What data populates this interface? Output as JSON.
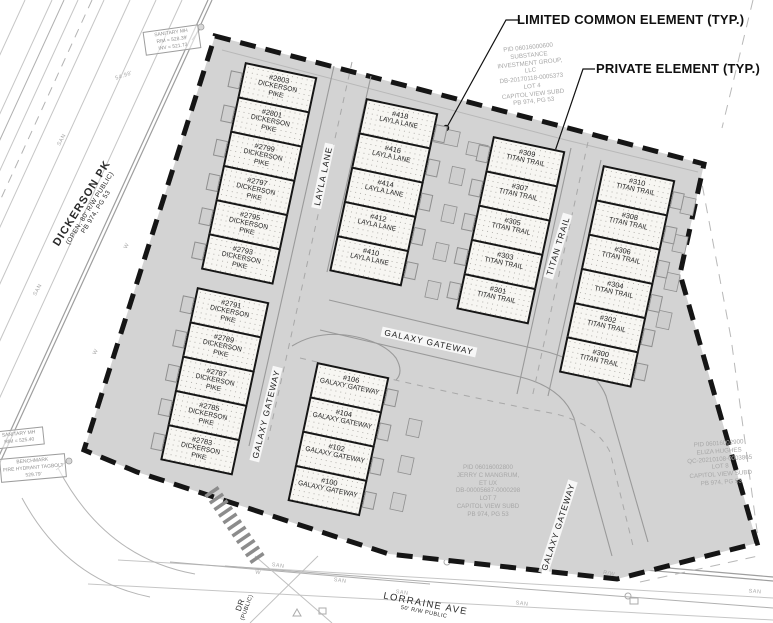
{
  "annotations": {
    "limited_common": "LIMITED COMMON ELEMENT (TYP.)",
    "private": "PRIVATE ELEMENT (TYP.)"
  },
  "streets": {
    "dickerson": {
      "name": "DICKERSON PK",
      "line2": "(OPEN, 80' R/W PUBLIC)",
      "line3": "PB 974, PG 53"
    },
    "layla_label": "LAYLA LANE",
    "titan_label": "TITAN TRAIL",
    "galaxy_label": "GALAXY GATEWAY",
    "lorraine": {
      "name": "LORRAINE AVE",
      "line2": "50' R/W PUBLIC"
    },
    "dr": {
      "name": "DR",
      "line2": "(PUBLIC)"
    }
  },
  "unit_columns": [
    {
      "name": "dickerson-pike-upper",
      "units": [
        {
          "number": "#2803",
          "street": "DICKERSON PIKE"
        },
        {
          "number": "#2801",
          "street": "DICKERSON PIKE"
        },
        {
          "number": "#2799",
          "street": "DICKERSON PIKE"
        },
        {
          "number": "#2797",
          "street": "DICKERSON PIKE"
        },
        {
          "number": "#2795",
          "street": "DICKERSON PIKE"
        },
        {
          "number": "#2793",
          "street": "DICKERSON PIKE"
        }
      ]
    },
    {
      "name": "dickerson-pike-lower",
      "units": [
        {
          "number": "#2791",
          "street": "DICKERSON PIKE"
        },
        {
          "number": "#2789",
          "street": "DICKERSON PIKE"
        },
        {
          "number": "#2787",
          "street": "DICKERSON PIKE"
        },
        {
          "number": "#2785",
          "street": "DICKERSON PIKE"
        },
        {
          "number": "#2783",
          "street": "DICKERSON PIKE"
        }
      ]
    },
    {
      "name": "layla-lane",
      "units": [
        {
          "number": "#418",
          "street": "LAYLA LANE"
        },
        {
          "number": "#416",
          "street": "LAYLA LANE"
        },
        {
          "number": "#414",
          "street": "LAYLA LANE"
        },
        {
          "number": "#412",
          "street": "LAYLA LANE"
        },
        {
          "number": "#410",
          "street": "LAYLA LANE"
        }
      ]
    },
    {
      "name": "titan-trail-west",
      "units": [
        {
          "number": "#309",
          "street": "TITAN TRAIL"
        },
        {
          "number": "#307",
          "street": "TITAN TRAIL"
        },
        {
          "number": "#305",
          "street": "TITAN TRAIL"
        },
        {
          "number": "#303",
          "street": "TITAN TRAIL"
        },
        {
          "number": "#301",
          "street": "TITAN TRAIL"
        }
      ]
    },
    {
      "name": "titan-trail-east",
      "units": [
        {
          "number": "#310",
          "street": "TITAN TRAIL"
        },
        {
          "number": "#308",
          "street": "TITAN TRAIL"
        },
        {
          "number": "#306",
          "street": "TITAN TRAIL"
        },
        {
          "number": "#304",
          "street": "TITAN TRAIL"
        },
        {
          "number": "#302",
          "street": "TITAN TRAIL"
        },
        {
          "number": "#300",
          "street": "TITAN TRAIL"
        }
      ]
    },
    {
      "name": "galaxy-gateway",
      "units": [
        {
          "number": "#106",
          "street": "GALAXY GATEWAY"
        },
        {
          "number": "#104",
          "street": "GALAXY GATEWAY"
        },
        {
          "number": "#102",
          "street": "GALAXY GATEWAY"
        },
        {
          "number": "#100",
          "street": "GALAXY GATEWAY"
        }
      ]
    }
  ],
  "parcels": [
    {
      "name": "lot-4",
      "lines": [
        "PID 06016000600",
        "SUBSTANCE",
        "INVESTMENT GROUP,",
        "LLC",
        "DB-20170118-0005373",
        "LOT 4",
        "CAPITOL VIEW SUBD",
        "PB 974, PG 53"
      ]
    },
    {
      "name": "lot-7",
      "lines": [
        "PID 06016002800",
        "JERRY C MANGRUM,",
        "ET UX",
        "DB-00005687-0000298",
        "LOT 7",
        "CAPITOL VIEW SUBD",
        "PB 974, PG 53"
      ]
    },
    {
      "name": "lot-8",
      "lines": [
        "PID 06016002900",
        "ELIZA HUGHES",
        "QC-20210108-0003865",
        "LOT 8",
        "CAPITOL VIEW SUBD",
        "PB 974, PG 53"
      ]
    }
  ],
  "survey_notes": [
    {
      "name": "sanitary-mh-north",
      "lines": [
        "SANITARY MH",
        "RIM = 528.39'",
        "INV = 521.73"
      ]
    },
    {
      "name": "sanitary-mh-south",
      "lines": [
        "SANITARY MH",
        "RIM = 525.40"
      ]
    },
    {
      "name": "benchmark",
      "lines": [
        "BENCHMARK",
        "FIRE HYDRANT TAGBOLT",
        "529.79'"
      ]
    }
  ],
  "utility": {
    "san": "SAN",
    "water": "W",
    "rw": "R/W",
    "dim": "54.98'"
  },
  "colors": {
    "site_fill": "#d3d3d3",
    "boundary": "#151515",
    "unit_fill": "#f7f6f2",
    "parcel_text": "#a7a7a7"
  }
}
